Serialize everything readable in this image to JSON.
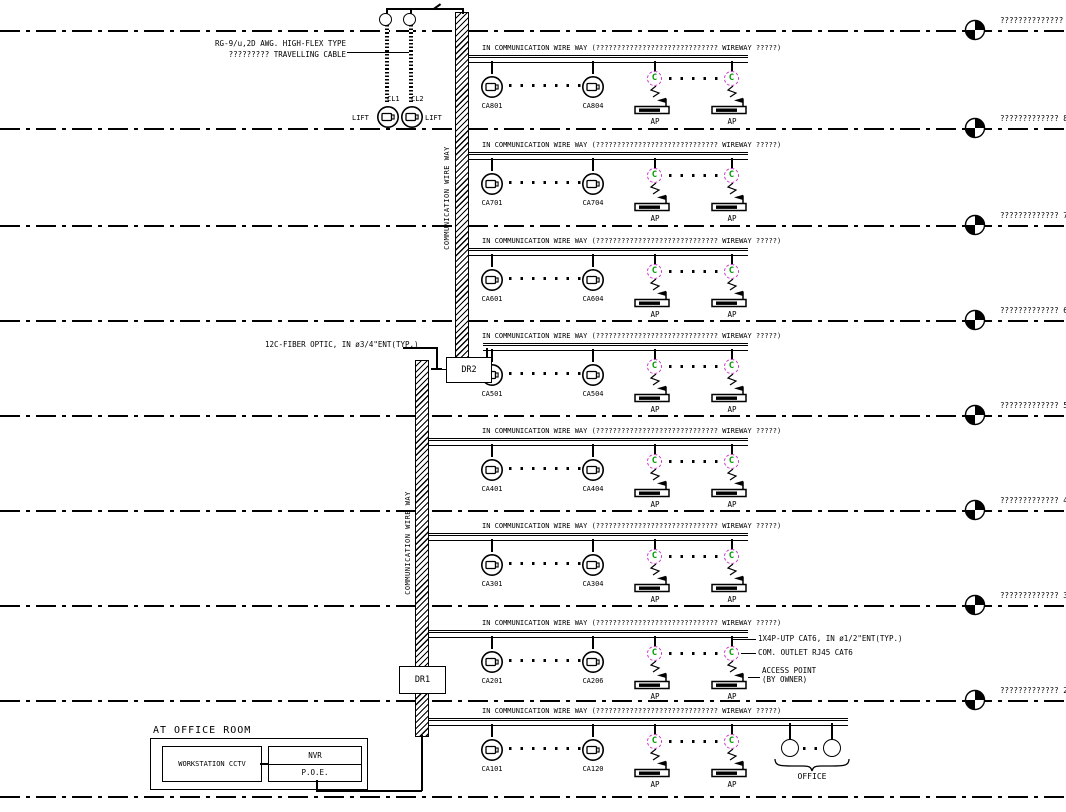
{
  "colors": {
    "line": "#000000",
    "com_outlet": "#cc33cc",
    "com_outlet_letter": "#009900"
  },
  "top_assembly": {
    "cable_note_line1": "RG-9/u,2D AWG. HIGH-FLEX TYPE",
    "cable_note_line2": "????????? TRAVELLING CABLE",
    "cl1_label": "CL1",
    "cl2_label": "CL2",
    "lift_left_label": "LIFT",
    "lift_right_label": "LIFT"
  },
  "risers": {
    "upper_label": "COMMUNICATION WIRE WAY",
    "lower_label": "COMMUNICATION WIRE WAY",
    "dr1_label": "DR1",
    "dr2_label": "DR2",
    "fiber_note": "12C-FIBER OPTIC, IN ø3/4\"ENT(TYP.)"
  },
  "wireway_caption": "IN COMMUNICATION WIRE WAY (????????????????????????????? WIREWAY ?????)",
  "device_labels": {
    "ap": "AP",
    "com_outlet_letter": "C"
  },
  "floors": [
    {
      "level": "8",
      "outlet_first": "CA801",
      "outlet_last": "CA804"
    },
    {
      "level": "7",
      "outlet_first": "CA701",
      "outlet_last": "CA704"
    },
    {
      "level": "6",
      "outlet_first": "CA601",
      "outlet_last": "CA604"
    },
    {
      "level": "5",
      "outlet_first": "CA501",
      "outlet_last": "CA504"
    },
    {
      "level": "4",
      "outlet_first": "CA401",
      "outlet_last": "CA404"
    },
    {
      "level": "3",
      "outlet_first": "CA301",
      "outlet_last": "CA304"
    },
    {
      "level": "2",
      "outlet_first": "CA201",
      "outlet_last": "CA206"
    },
    {
      "level": "1",
      "outlet_first": "CA101",
      "outlet_last": "CA120"
    }
  ],
  "levels": [
    {
      "label": "??????????????"
    },
    {
      "label": "????????????? 8"
    },
    {
      "label": "????????????? 7"
    },
    {
      "label": "????????????? 6"
    },
    {
      "label": "????????????? 5"
    },
    {
      "label": "????????????? 4"
    },
    {
      "label": "????????????? 3"
    },
    {
      "label": "????????????? 2"
    }
  ],
  "floor2_callouts": {
    "utp_note": "1X4P-UTP CAT6, IN ø1/2\"ENT(TYP.)",
    "outlet_note": "COM. OUTLET RJ45 CAT6",
    "ap_note_line1": "ACCESS POINT",
    "ap_note_line2": "(BY OWNER)"
  },
  "office_room": {
    "title": "AT OFFICE ROOM",
    "workstation_label": "WORKSTATION CCTV",
    "nvr_label": "NVR",
    "poe_label": "P.O.E."
  },
  "office_zone": {
    "label": "OFFICE"
  }
}
